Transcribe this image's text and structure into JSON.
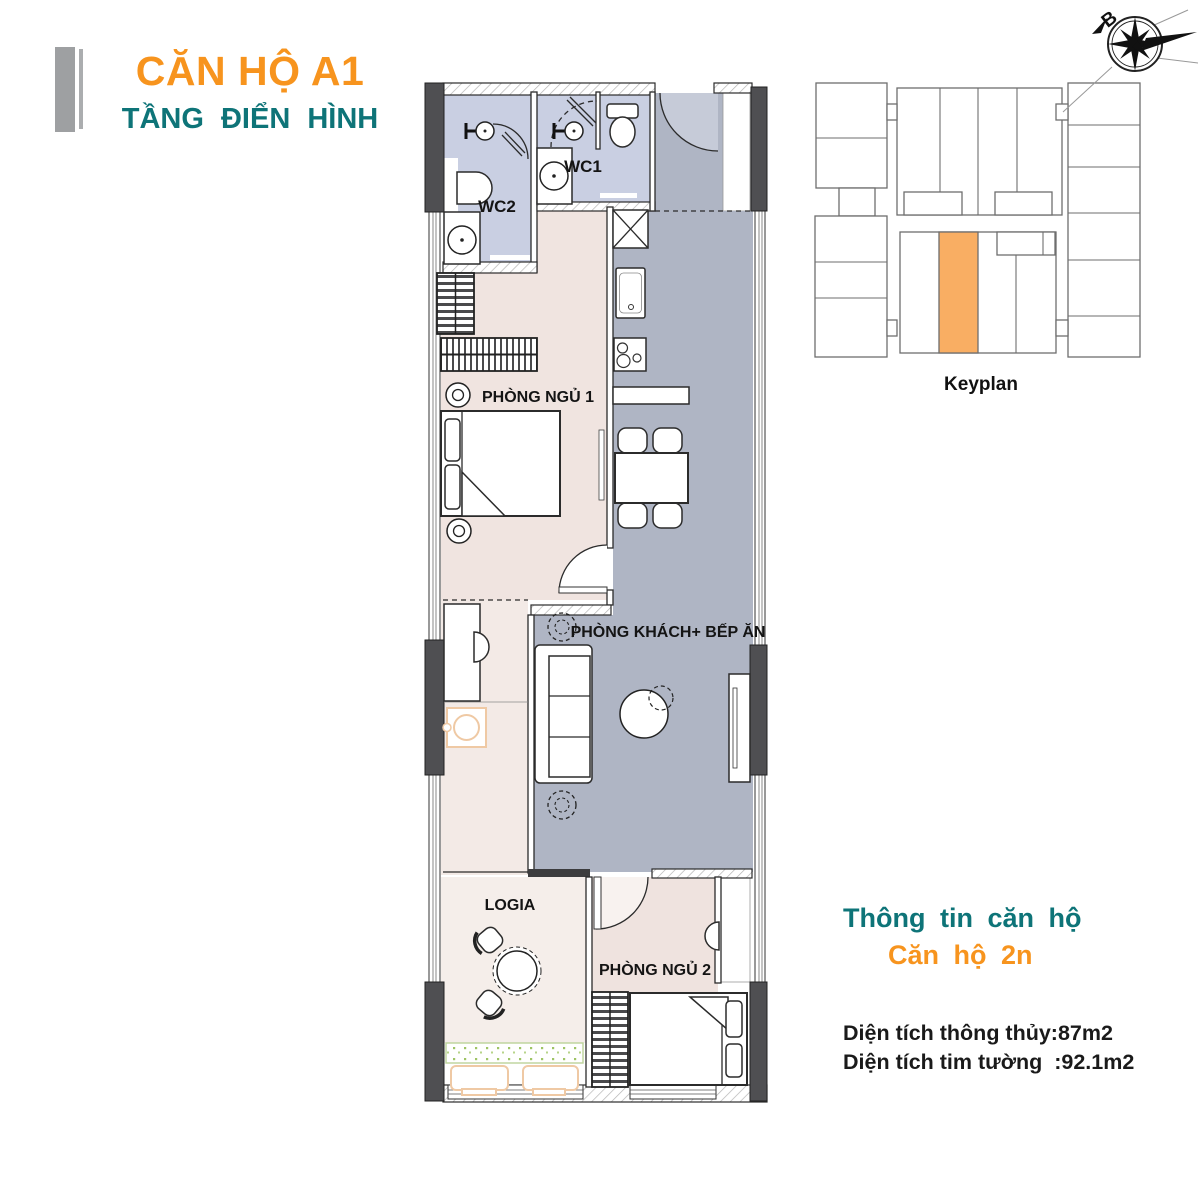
{
  "header": {
    "title": "CĂN HỘ A1",
    "subtitle": "TẦNG ĐIỂN HÌNH"
  },
  "compass": {
    "north_label": "B"
  },
  "keyplan": {
    "label": "Keyplan"
  },
  "plan": {
    "rooms": {
      "wc1": "WC1",
      "wc2": "WC2",
      "bedroom1": "PHÒNG NGỦ 1",
      "living": "PHÒNG KHÁCH+ BẾP ĂN",
      "logia": "LOGIA",
      "bedroom2": "PHÒNG NGỦ 2"
    }
  },
  "info": {
    "title": "Thông tin căn hộ",
    "unit": "Căn hộ 2n",
    "area_net": "Diện tích thông thủy:87m2",
    "area_gross": "Diện tích tim tường  :92.1m2"
  },
  "colors": {
    "orange": "#F7941E",
    "teal": "#0E7478",
    "info_black": "#1A1A1A",
    "keyplan_highlight": "#F9AE63",
    "wall_dark": "#4F4F52",
    "floor_gray": "#AFB5C4",
    "wc_blue": "#C9CFE2",
    "bedroom_pink": "#F0E4E0",
    "bedroom2_pink": "#EFE3DF",
    "corridor_pink": "#F3EAE6",
    "logia_pink": "#F5EEEA",
    "door_gray": "#C6CBD8",
    "planter_orange": "#EFC9A4",
    "planter_green": "#9EC465"
  }
}
